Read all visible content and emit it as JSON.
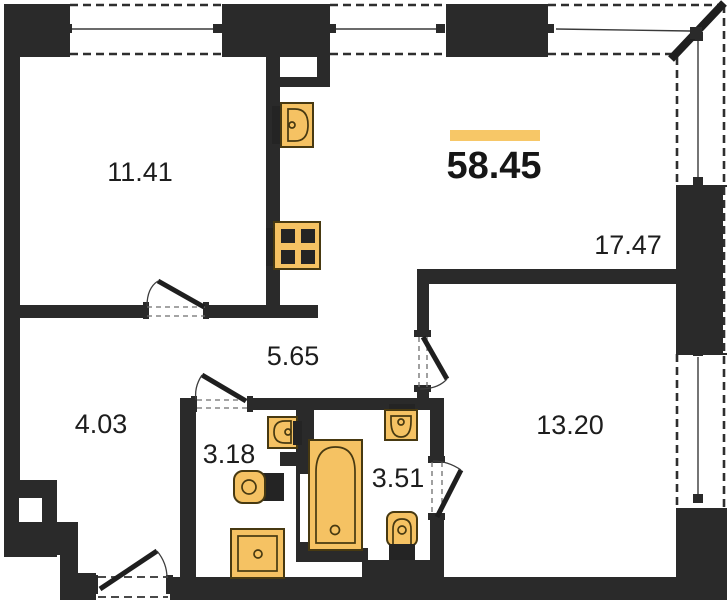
{
  "plan": {
    "title": "apartment-floor-plan",
    "total": {
      "area": "58.45"
    },
    "rooms": {
      "bedroom1": {
        "area": "11.41"
      },
      "living_kitchen": {
        "area": "17.47"
      },
      "hallway": {
        "area": "5.65"
      },
      "corridor": {
        "area": "4.03"
      },
      "wc": {
        "area": "3.18"
      },
      "bathroom": {
        "area": "3.51"
      },
      "bedroom2": {
        "area": "13.20"
      }
    },
    "fixtures": [
      "kitchen-sink",
      "stove",
      "bathtub",
      "washbasin",
      "toilet",
      "washing-machine"
    ],
    "colors": {
      "wall": "#2a2a2a",
      "fixture_fill": "#f5c263",
      "fixture_stroke": "#473911",
      "accent_bar": "#f7c767",
      "label_text": "#1d1d1d"
    }
  }
}
